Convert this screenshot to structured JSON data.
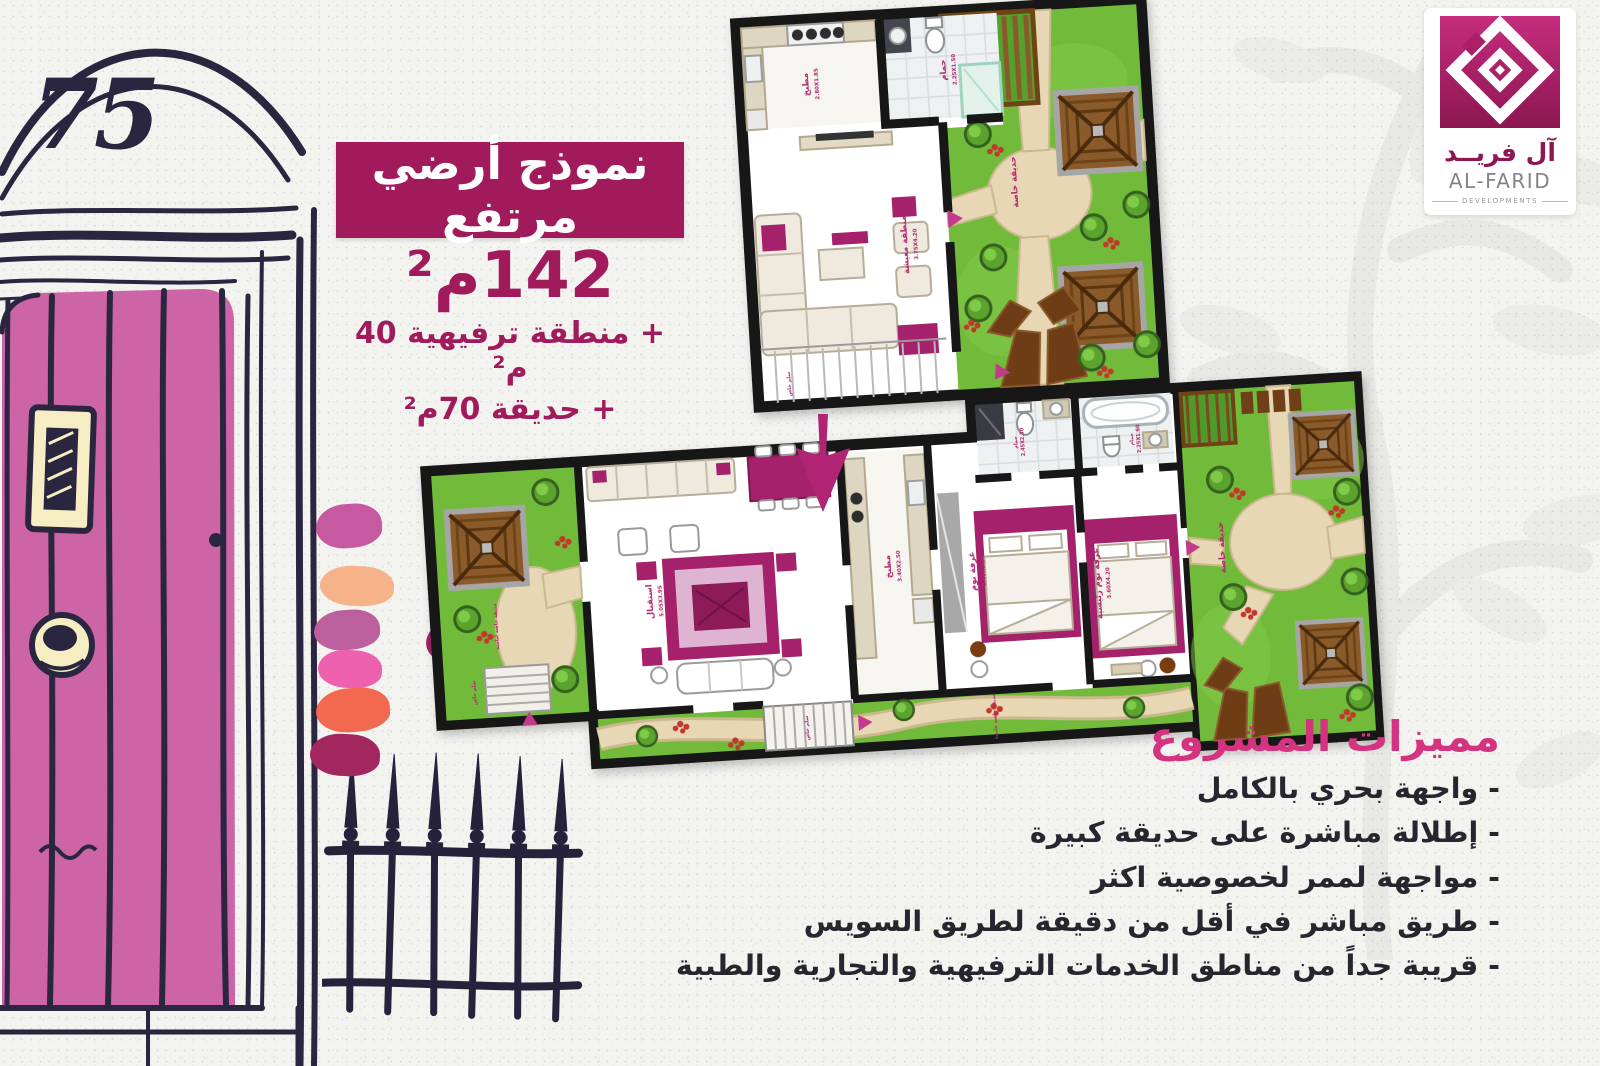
{
  "palette": {
    "background": "#f3f3f0",
    "ink": "#2b2640",
    "banner": "#a11a5c",
    "headline_pink": "#d43380",
    "door_pink": "#cd64a5",
    "grass": "#72bb3a",
    "path_tan": "#e7d7b4",
    "wood": "#8a5a2b",
    "furniture_magenta": "#a6216b",
    "label_magenta": "#b2256b"
  },
  "logo": {
    "brand_ar": "آل فريــد",
    "brand_en": "AL-FARID",
    "tagline": "DEVELOPMENTS",
    "gradient_top": "#c62d7d",
    "gradient_bottom": "#8c1652"
  },
  "door": {
    "number": "75",
    "color": "#cd64a5"
  },
  "offer": {
    "banner": "نموذج أرضي مرتفع",
    "banner_bg": "#a11a5c",
    "area": "142م²",
    "extra_1": "+ منطقة ترفيهية 40 م²",
    "extra_2": "+ حديقة 70م²"
  },
  "features": {
    "title": "مميزات المشروع",
    "items": [
      "- واجهة بحري بالكامل",
      "- إطلالة مباشرة على حديقة كبيرة",
      "- مواجهة لممر لخصوصية اكثر",
      "- طريق مباشر في أقل من دقيقة لطريق السويس",
      "- قريبة جداً من مناطق الخدمات الترفيهية والتجارية والطبية"
    ]
  },
  "plan_top": {
    "kitchen": "مطبخ",
    "kitchen_dim": "2.80X1.85",
    "bath": "حمام",
    "bath_dim": "2.25X1.50",
    "living": "منطقة معيشة",
    "living_dim": "3.75X4.20",
    "garden": "حديقة خاصة",
    "stairs": "سلم خاص"
  },
  "plan_main": {
    "front_garden": "حديقة خاصة أمامية",
    "front_stairs": "سلم خاص",
    "reception": "استقبال",
    "reception_dim": "5.05X3.95",
    "kitchen": "مطبخ",
    "kitchen_dim": "3.40X2.50",
    "bedroom": "غرفة نوم",
    "bedroom_dim": "3.60X3.30",
    "master": "غرفة نوم رئيسية",
    "master_dim": "3.60X4.20",
    "bath_1": "حمام",
    "bath_1_dim": "2.45X2.30",
    "bath_2": "حمام",
    "bath_2_dim": "2.25X1.60",
    "garden": "حديقة خاصة",
    "side_garden": "حديقة خاصة جانبية",
    "side_stairs": "سلم خاص"
  },
  "swatches": [
    {
      "name": "orchid",
      "color": "#c6599f"
    },
    {
      "name": "peach",
      "color": "#f6b289"
    },
    {
      "name": "mauve",
      "color": "#bc5f9d"
    },
    {
      "name": "hot-pink",
      "color": "#ee61ae"
    },
    {
      "name": "coral",
      "color": "#f26950"
    },
    {
      "name": "plum",
      "color": "#a3275f"
    },
    {
      "name": "coral-2",
      "color": "#f26c50"
    },
    {
      "name": "magenta",
      "color": "#9c2161"
    },
    {
      "name": "peach-2",
      "color": "#f6b78e"
    }
  ]
}
